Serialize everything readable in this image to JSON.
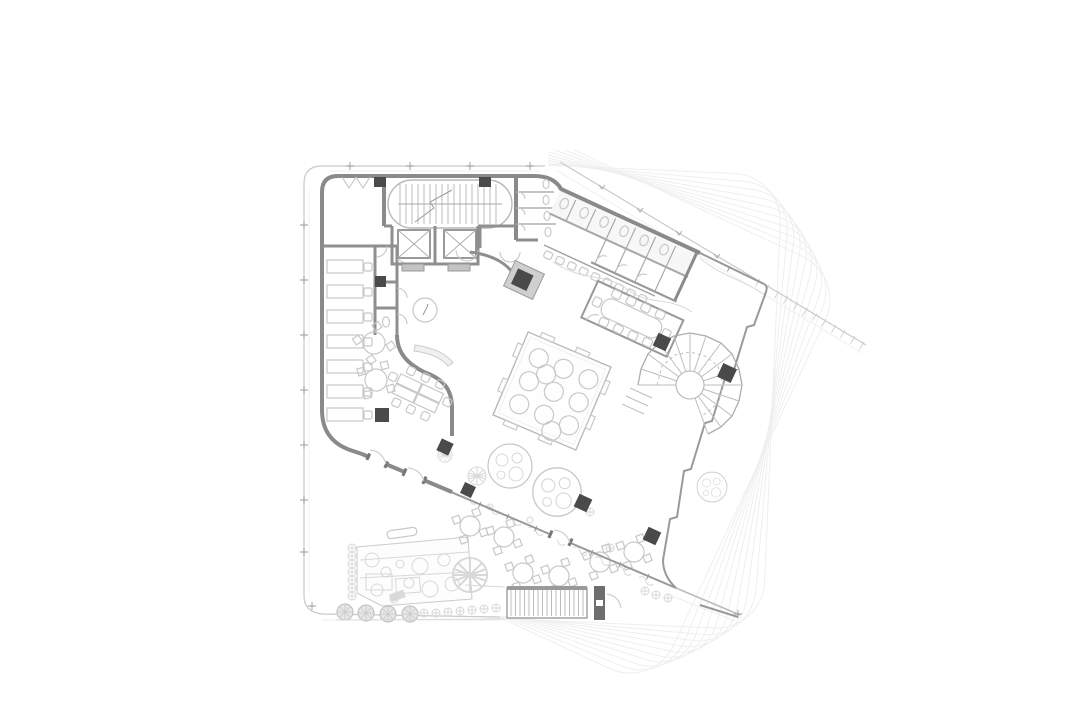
{
  "document": {
    "title": "Architectural ground floor plan",
    "type": "technical line drawing, top-down floor plan",
    "visible_text": "none"
  },
  "palette": {
    "background": "#ffffff",
    "wall_gray": "#8a8a8a",
    "column_dark": "#4a4a4a",
    "thin_line": "#c9c9c9",
    "faint_floor_outlines": "#efefef",
    "furniture_line": "#c8c8c8"
  },
  "plan_features": {
    "core": [
      "scissor-stair-oval",
      "elevator-shaft-1",
      "elevator-shaft-2",
      "toilet-stall-block"
    ],
    "rotated_wing": [
      "restroom-band",
      "meeting-room",
      "winding-stair",
      "sawtooth-glass-edge"
    ],
    "left_zone": [
      "desk-row",
      "round-tables",
      "info-desk",
      "workshop-table-group",
      "s-curve-wall"
    ],
    "center": [
      "sunken-courtyard-square",
      "courtyard-round-seats"
    ],
    "terrace": [
      "canopy-trees",
      "outdoor-tables",
      "playground-garden",
      "exterior-stair",
      "shrub-rows",
      "hedge-marks"
    ],
    "context": [
      "rotated-upper-floor-outlines",
      "canopy-edge-line",
      "site-boundary"
    ]
  },
  "counts": {
    "upper_floor_outlines": 10,
    "elevators": 2,
    "staircases": 3,
    "structural_columns": 11,
    "desks": 7,
    "office_round_tables": 2,
    "terrace_tables": 6,
    "meeting_room_seats": 10,
    "courtyard_seats": 11,
    "trees": 6
  }
}
